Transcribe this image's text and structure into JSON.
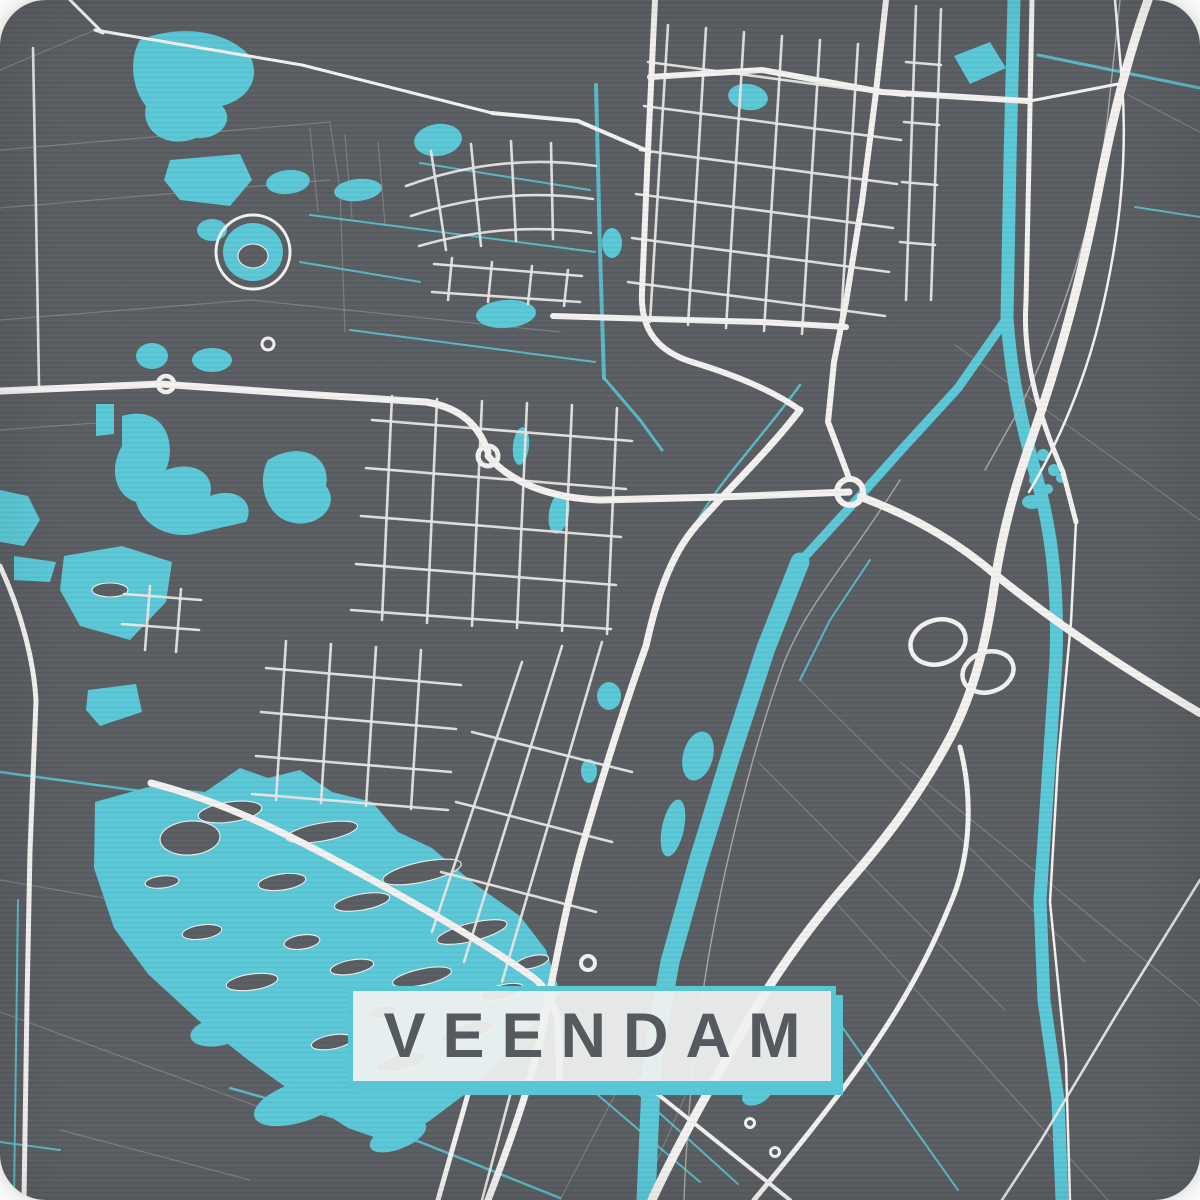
{
  "poster": {
    "title": "VEENDAM",
    "colors": {
      "page_background": "#fbfbfa",
      "map_background": "#5a5d61",
      "water": "#5bc8d7",
      "water_line": "#5bc8d7",
      "road_major": "#f3f2f0",
      "road_minor": "#e7e7e5",
      "faint_line": "#97999c",
      "railway": "#b9babb",
      "island": "#5a5d61",
      "island_outline": "#f0f0ee",
      "label_background": "rgba(239,241,240,0.94)",
      "label_border": "#58c6d5",
      "label_shadow": "#58c6d5",
      "label_text": "#565a5e"
    }
  },
  "map": {
    "faint_lines": [
      "M0,70 L95,30",
      "M0,150 L330,122",
      "M0,208 L330,180",
      "M0,320 L250,300 L560,332",
      "M330,122 L340,190 L345,332",
      "M310,128 L318,212",
      "M345,135 L352,218",
      "M378,142 L385,224",
      "M0,430 L110,422",
      "M955,345 L1200,520",
      "M1128,95 L1200,132",
      "M800,680 L1085,962",
      "M758,762 L1005,1010",
      "M900,762 L1200,1005",
      "M838,905 L1108,1200",
      "M0,1012 L300,1122",
      "M60,1130 L250,1180",
      "M0,880 L115,900",
      "M620,1085 L560,1200",
      "M690,1085 L640,1200"
    ],
    "cyan_lines": [
      {
        "d": "M1038,55 L1200,88",
        "w": 3
      },
      {
        "d": "M1135,207 L1200,217",
        "w": 2
      },
      {
        "d": "M596,85 L600,250 L604,378",
        "w": 4
      },
      {
        "d": "M800,385 C760,440 720,480 695,525 C668,570 655,610 645,648 C620,715 598,790 575,880 C560,940 550,1000 542,1050",
        "w": 2.5
      },
      {
        "d": "M310,215 L595,252",
        "w": 2
      },
      {
        "d": "M420,163 L590,190",
        "w": 2
      },
      {
        "d": "M300,262 L420,282",
        "w": 2
      },
      {
        "d": "M350,330 L595,362",
        "w": 2
      },
      {
        "d": "M0,772 L148,792",
        "w": 2.5
      },
      {
        "d": "M0,1142 L60,1150",
        "w": 2
      },
      {
        "d": "M230,1088 L420,1142 L560,1198",
        "w": 2.5
      },
      {
        "d": "M592,1090 L700,1182",
        "w": 2
      },
      {
        "d": "M634,1090 L738,1184",
        "w": 2
      },
      {
        "d": "M830,1010 L958,1190",
        "w": 2
      },
      {
        "d": "M18,900 L14,1200",
        "w": 2
      },
      {
        "d": "M870,560 L830,620 L800,680",
        "w": 2
      },
      {
        "d": "M604,378 L640,420 L662,450",
        "w": 3
      }
    ],
    "canals": [
      {
        "d": "M1014,0 L1010,160 L1007,318",
        "w": 13
      },
      {
        "d": "M1007,318 C1012,390 1026,440 1040,490 C1054,545 1058,600 1056,660 L1048,780 L1040,900 L1044,1000 L1058,1100 L1062,1200",
        "w": 13
      },
      {
        "d": "M1007,318 L958,388 L903,448 L852,505 L800,562",
        "w": 9
      },
      {
        "d": "M800,562 L766,648 L732,752 L698,862 L670,962 L652,1062 L646,1200",
        "w": 19
      }
    ],
    "water_fills": [
      "M95,802 L152,786 L205,792 L240,768 L268,778 L300,770 L332,792 L372,802 L398,832 L432,848 L472,882 L520,916 L546,950 L560,992 L545,1012 L518,1038 L498,1062 L468,1092 L428,1122 L388,1142 L348,1128 L298,1096 L248,1060 L198,1020 L148,974 L114,928 L94,868 Z",
      "M96,404 L114,404 L114,434 L96,436 Z",
      "M122,416 C162,404 178,440 166,470 C192,460 216,472 210,496 C236,486 256,502 246,522 L202,532 C172,542 142,526 136,502 C116,496 108,470 122,446 Z",
      "M268,460 C300,440 332,456 326,486 C342,506 316,530 290,522 C266,516 256,482 268,460 Z",
      "M64,556 L122,546 L172,562 L166,602 L130,640 L80,626 L60,590 Z",
      "M0,490 L28,496 L40,520 L24,546 L0,542 Z",
      "M14,556 L56,562 L50,582 L14,580 Z",
      "M88,690 L136,684 L142,712 L100,726 L86,710 Z",
      "M140,40 C180,24 226,30 250,56 C262,80 246,100 222,106 C236,120 220,140 196,138 C166,150 140,130 146,106 C130,86 130,56 140,40 Z",
      "M170,160 L240,154 L252,180 L230,206 L180,200 L164,180 Z",
      "M954,56 L990,42 L1006,68 L970,84 Z"
    ],
    "water_ellipses": [
      {
        "cx": 300,
        "cy": 1102,
        "rx": 48,
        "ry": 20,
        "rot": -18
      },
      {
        "cx": 398,
        "cy": 1136,
        "rx": 30,
        "ry": 13,
        "rot": -22
      },
      {
        "cx": 218,
        "cy": 1032,
        "rx": 28,
        "ry": 14,
        "rot": -10
      },
      {
        "cx": 152,
        "cy": 356,
        "rx": 16,
        "ry": 13,
        "rot": 0
      },
      {
        "cx": 212,
        "cy": 360,
        "rx": 20,
        "ry": 12,
        "rot": 0
      },
      {
        "cx": 212,
        "cy": 230,
        "rx": 15,
        "ry": 11,
        "rot": 0
      },
      {
        "cx": 288,
        "cy": 182,
        "rx": 22,
        "ry": 12,
        "rot": -6
      },
      {
        "cx": 358,
        "cy": 190,
        "rx": 24,
        "ry": 11,
        "rot": -6
      },
      {
        "cx": 438,
        "cy": 140,
        "rx": 24,
        "ry": 16,
        "rot": -8
      },
      {
        "cx": 253,
        "cy": 252,
        "rx": 30,
        "ry": 29,
        "rot": 0
      },
      {
        "cx": 748,
        "cy": 97,
        "rx": 20,
        "ry": 13,
        "rot": 8
      },
      {
        "cx": 506,
        "cy": 314,
        "rx": 30,
        "ry": 14,
        "rot": -4
      },
      {
        "cx": 612,
        "cy": 243,
        "rx": 10,
        "ry": 15,
        "rot": 0
      },
      {
        "cx": 521,
        "cy": 446,
        "rx": 8,
        "ry": 19,
        "rot": 6
      },
      {
        "cx": 559,
        "cy": 513,
        "rx": 10,
        "ry": 21,
        "rot": 10
      },
      {
        "cx": 698,
        "cy": 756,
        "rx": 15,
        "ry": 25,
        "rot": 15
      },
      {
        "cx": 673,
        "cy": 828,
        "rx": 11,
        "ry": 29,
        "rot": 12
      },
      {
        "cx": 609,
        "cy": 696,
        "rx": 12,
        "ry": 14,
        "rot": 0
      },
      {
        "cx": 589,
        "cy": 771,
        "rx": 8,
        "ry": 12,
        "rot": 0
      },
      {
        "cx": 1032,
        "cy": 502,
        "rx": 10,
        "ry": 7,
        "rot": 0
      },
      {
        "cx": 757,
        "cy": 1094,
        "rx": 16,
        "ry": 10,
        "rot": -28
      }
    ],
    "water_dots": [
      {
        "cx": 1028,
        "cy": 462,
        "r": 6
      },
      {
        "cx": 1043,
        "cy": 455,
        "r": 6
      },
      {
        "cx": 1054,
        "cy": 470,
        "r": 6
      },
      {
        "cx": 1034,
        "cy": 480,
        "r": 5
      },
      {
        "cx": 1048,
        "cy": 489,
        "r": 5
      },
      {
        "cx": 1061,
        "cy": 478,
        "r": 5
      }
    ],
    "islands": [
      {
        "cx": 230,
        "cy": 812,
        "rx": 32,
        "ry": 10,
        "rot": -8
      },
      {
        "cx": 322,
        "cy": 832,
        "rx": 36,
        "ry": 9,
        "rot": -10
      },
      {
        "cx": 422,
        "cy": 872,
        "rx": 40,
        "ry": 10,
        "rot": -12
      },
      {
        "cx": 362,
        "cy": 902,
        "rx": 28,
        "ry": 8,
        "rot": -10
      },
      {
        "cx": 282,
        "cy": 882,
        "rx": 24,
        "ry": 8,
        "rot": -8
      },
      {
        "cx": 472,
        "cy": 932,
        "rx": 36,
        "ry": 9,
        "rot": -14
      },
      {
        "cx": 422,
        "cy": 977,
        "rx": 30,
        "ry": 8,
        "rot": -12
      },
      {
        "cx": 352,
        "cy": 967,
        "rx": 22,
        "ry": 7,
        "rot": -10
      },
      {
        "cx": 302,
        "cy": 942,
        "rx": 18,
        "ry": 7,
        "rot": -8
      },
      {
        "cx": 502,
        "cy": 992,
        "rx": 22,
        "ry": 7,
        "rot": -14
      },
      {
        "cx": 467,
        "cy": 1032,
        "rx": 28,
        "ry": 8,
        "rot": -16
      },
      {
        "cx": 402,
        "cy": 1062,
        "rx": 26,
        "ry": 8,
        "rot": -14
      },
      {
        "cx": 332,
        "cy": 1042,
        "rx": 21,
        "ry": 7,
        "rot": -10
      },
      {
        "cx": 252,
        "cy": 982,
        "rx": 26,
        "ry": 8,
        "rot": -8
      },
      {
        "cx": 202,
        "cy": 932,
        "rx": 20,
        "ry": 7,
        "rot": -8
      },
      {
        "cx": 162,
        "cy": 882,
        "rx": 17,
        "ry": 6,
        "rot": -6
      },
      {
        "cx": 532,
        "cy": 962,
        "rx": 17,
        "ry": 6,
        "rot": -14
      },
      {
        "cx": 382,
        "cy": 1012,
        "rx": 15,
        "ry": 6,
        "rot": -10
      },
      {
        "cx": 190,
        "cy": 838,
        "rx": 30,
        "ry": 17,
        "rot": -4
      },
      {
        "cx": 110,
        "cy": 590,
        "rx": 18,
        "ry": 7,
        "rot": 0
      },
      {
        "cx": 253,
        "cy": 256,
        "rx": 15,
        "ry": 12,
        "rot": 0
      }
    ],
    "railways": [
      "M1120,0 L1107,122 C1095,222 1062,320 1020,408 L985,470",
      "M900,480 C850,560 810,600 785,660 C755,740 725,860 708,960 C695,1040 688,1100 684,1200"
    ],
    "minor_roads": [
      "M668,25 L650,322",
      "M706,28 L688,325",
      "M744,32 L726,328",
      "M782,36 L764,331",
      "M820,40 L802,334",
      "M858,44 L840,337",
      "M648,62 L905,96",
      "M644,106 L901,140",
      "M640,150 L897,184",
      "M636,194 L893,228",
      "M632,238 L889,272",
      "M628,282 L885,316",
      "M392,396 L382,620",
      "M437,399 L427,623",
      "M482,401 L472,626",
      "M527,403 L517,628",
      "M572,405 L562,631",
      "M617,408 L607,634",
      "M372,420 L632,441",
      "M366,468 L626,489",
      "M361,516 L621,537",
      "M356,564 L616,585",
      "M351,610 L611,629",
      "M286,641 L276,800",
      "M331,644 L321,803",
      "M376,647 L366,806",
      "M421,650 L411,809",
      "M266,668 L461,685",
      "M261,712 L456,729",
      "M256,756 L451,772",
      "M252,794 L448,810",
      "M602,642 L502,982",
      "M562,646 L464,962",
      "M522,662 L432,932",
      "M472,732 L632,772",
      "M456,802 L612,842",
      "M441,872 L596,912",
      "M406,186 Q500,152 596,166",
      "M411,216 Q501,186 593,199",
      "M419,246 Q506,221 591,233",
      "M431,151 L446,250",
      "M471,144 L481,246",
      "M511,141 L516,241",
      "M551,143 L553,239",
      "M434,264 L582,276",
      "M432,292 L580,302",
      "M452,258 L448,300",
      "M492,262 L488,302",
      "M532,266 L528,304",
      "M568,270 L564,306",
      "M916,6 L906,300",
      "M941,9 L931,300",
      "M906,62 L941,65",
      "M904,122 L939,125",
      "M902,182 L937,185",
      "M900,242 L935,245",
      "M124,594 L201,600",
      "M122,624 L199,630",
      "M150,586 L145,650",
      "M181,589 L176,652",
      "M1200,880 L1118,1012 L1040,1142 L1002,1200",
      "M33,48 L36,210 L39,386",
      "M512,1088 L482,1200"
    ],
    "major_roads": [
      {
        "d": "M0,391 L160,384 L302,394 L426,402 C462,408 479,426 488,452",
        "w": 7
      },
      {
        "d": "M488,456 C512,484 552,498 600,500 L720,497 L849,492",
        "w": 7
      },
      {
        "d": "M861,497 C922,520 962,546 997,576 C1042,612 1102,656 1200,713",
        "w": 8
      },
      {
        "d": "M1148,0 C1126,62 1112,122 1100,182 C1081,281 1059,361 1031,441 C1011,497 1001,541 995,581 C987,641 974,691 951,736 C919,796 884,841 849,881 C806,930 768,984 736,1042 C706,1096 676,1148 652,1200",
        "w": 9
      },
      {
        "d": "M960,747 C974,801 970,861 949,907 C919,981 879,1042 829,1107 C799,1146 774,1176 754,1200",
        "w": 5
      },
      {
        "d": "M640,1080 L790,1200",
        "w": 4
      },
      {
        "d": "M655,0 L648,150 L642,292 C640,332 660,352 692,362 C738,376 775,392 800,410",
        "w": 6
      },
      {
        "d": "M800,410 C766,454 726,491 696,526 C669,557 656,601 646,646 C622,713 601,781 581,851 C566,906 556,961 546,1011 C536,1066 518,1122 488,1200",
        "w": 7
      },
      {
        "d": "M470,1087 L438,1200",
        "w": 5
      },
      {
        "d": "M650,77 L762,70 L882,92 L1028,101",
        "w": 6
      },
      {
        "d": "M886,0 L876,92 L862,202 L846,302 L834,362 L828,422 L849,478",
        "w": 6
      },
      {
        "d": "M553,316 L652,319 L762,322 L846,327",
        "w": 6
      },
      {
        "d": "M95,30 L302,65 L492,113",
        "w": 3
      },
      {
        "d": "M492,113 L578,121 L650,152",
        "w": 4
      },
      {
        "d": "M70,0 L103,33 L95,30",
        "w": 3
      },
      {
        "d": "M1032,0 L1029,160 L1026,302 C1022,362 1041,422 1063,472 L1076,522",
        "w": 5
      },
      {
        "d": "M1076,522 L1071,622 L1058,762 L1050,902 L1066,1062 L1070,1200",
        "w": 2.5
      },
      {
        "d": "M1115,0 L1122,82 C1128,162 1119,242 1099,322 C1084,382 1059,442 1029,492",
        "w": 2.5
      },
      {
        "d": "M0,566 C21,611 34,661 36,701 L30,851 L27,1001 L24,1200",
        "w": 5
      },
      {
        "d": "M151,783 C221,801 281,831 341,863 C421,906 481,941 531,976 C546,986 553,1001 558,1021 L560,1088",
        "w": 7
      },
      {
        "d": "M1030,101 L1118,84",
        "w": 3
      }
    ],
    "interchange_loops": [
      {
        "cx": 938,
        "cy": 642,
        "rx": 28,
        "ry": 22,
        "rot": -18,
        "w": 4.5
      },
      {
        "cx": 988,
        "cy": 672,
        "rx": 26,
        "ry": 20,
        "rot": -18,
        "w": 4.5
      }
    ],
    "roundabouts": [
      {
        "cx": 166,
        "cy": 384,
        "r": 8,
        "w": 4.5
      },
      {
        "cx": 488,
        "cy": 456,
        "r": 10,
        "w": 5
      },
      {
        "cx": 850,
        "cy": 492,
        "r": 13,
        "w": 6
      },
      {
        "cx": 588,
        "cy": 963,
        "r": 7,
        "w": 4
      },
      {
        "cx": 750,
        "cy": 1123,
        "r": 4.5,
        "w": 3
      },
      {
        "cx": 775,
        "cy": 1152,
        "r": 4.5,
        "w": 3
      },
      {
        "cx": 253,
        "cy": 252,
        "r": 37,
        "w": 3
      },
      {
        "cx": 268,
        "cy": 344,
        "r": 6,
        "w": 3
      }
    ]
  }
}
